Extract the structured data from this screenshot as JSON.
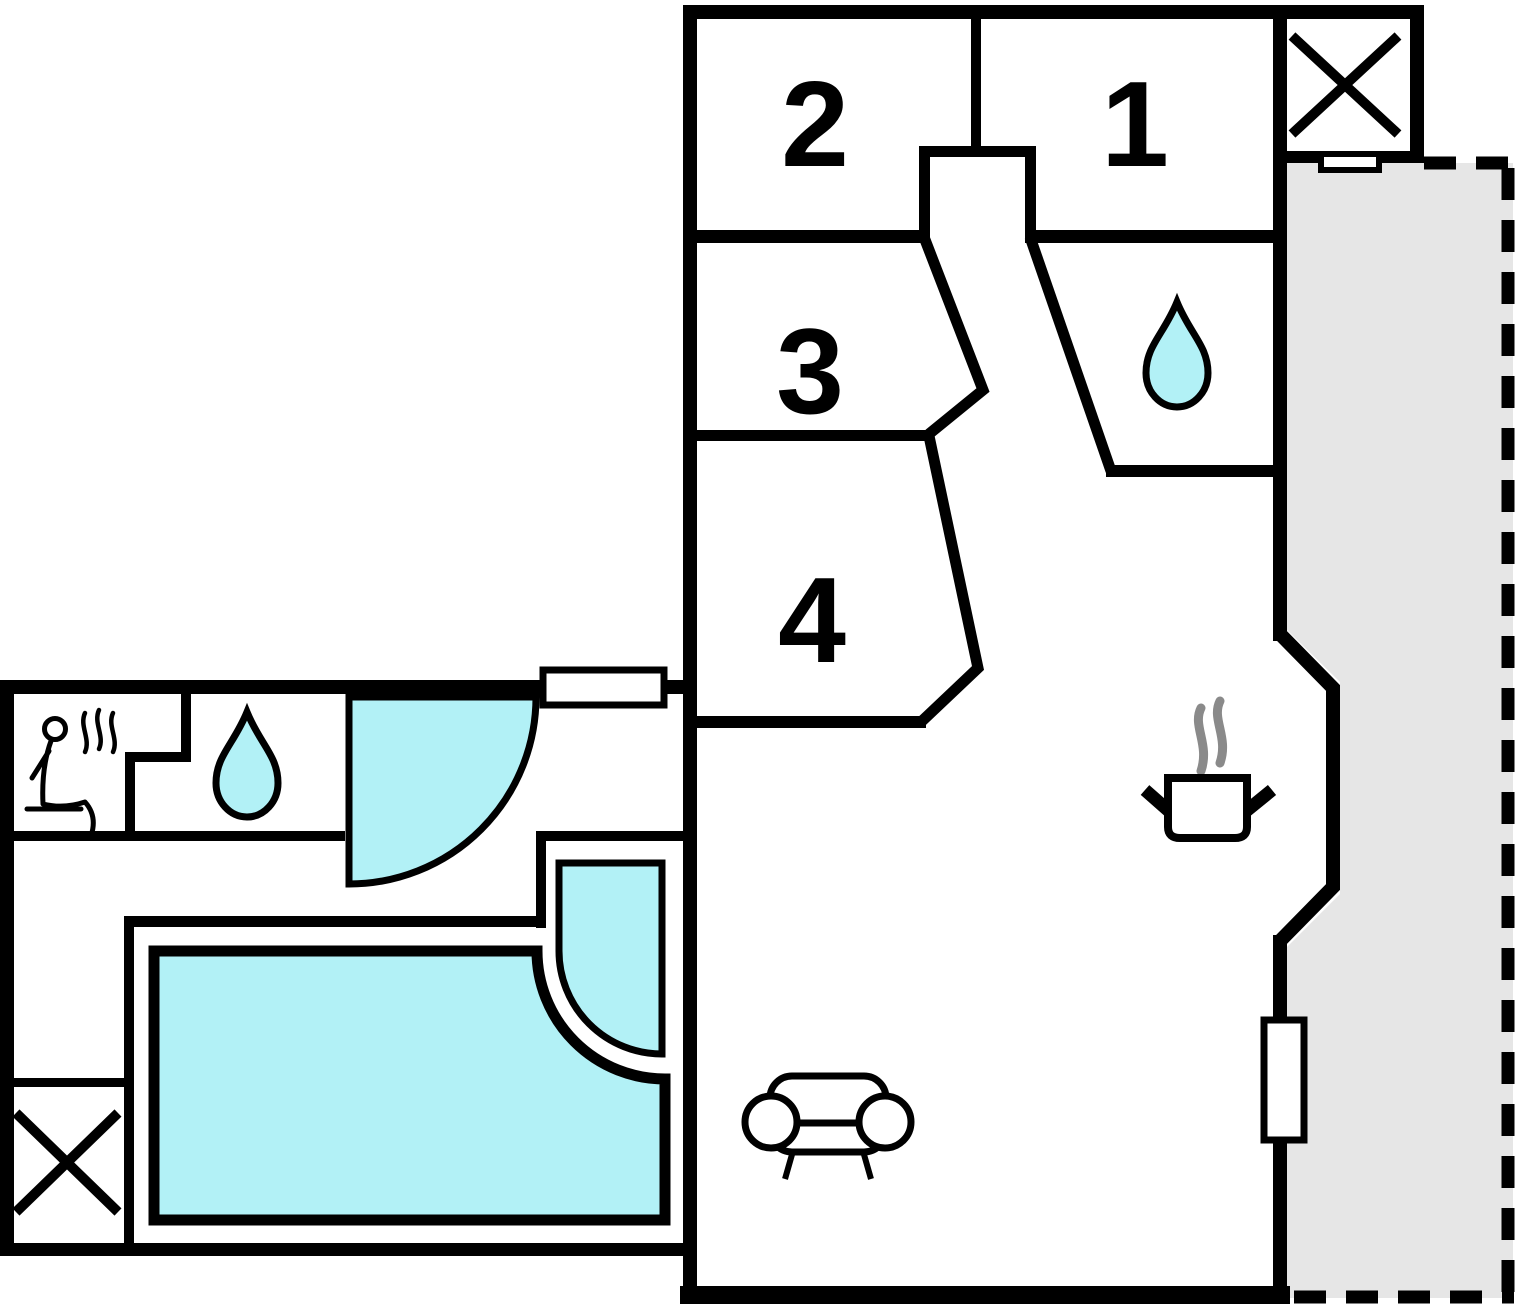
{
  "title": "holiday-home-floor-plan",
  "colors": {
    "wall": "#000000",
    "water": "#b2f1f6",
    "terrace": "#e6e6e6",
    "steam": "#8a8a8a",
    "background": "#ffffff"
  },
  "rooms": [
    {
      "id": "room-1",
      "label": "1"
    },
    {
      "id": "room-2",
      "label": "2"
    },
    {
      "id": "room-3",
      "label": "3"
    },
    {
      "id": "room-4",
      "label": "4"
    }
  ],
  "features": {
    "bathroom_upper": {
      "icon": "water-drop-icon"
    },
    "bathroom_annex": {
      "icon": "water-drop-icon"
    },
    "sauna": {
      "icon": "sauna-person-icon"
    },
    "kitchen": {
      "icon": "cooking-pot-icon"
    },
    "living_room": {
      "icon": "sofa-icon"
    },
    "pool": {
      "name": "swimming-pool"
    },
    "shower": {
      "name": "shower-cabin"
    },
    "terrace": {
      "name": "terrace-area"
    },
    "cross_top_right": {
      "icon": "window-cross-icon"
    },
    "cross_annex": {
      "icon": "window-cross-icon"
    },
    "door_annex": {
      "name": "door-swing-arc"
    },
    "windows": [
      "window-annex-top",
      "window-chimney-room",
      "window-living-right"
    ]
  }
}
